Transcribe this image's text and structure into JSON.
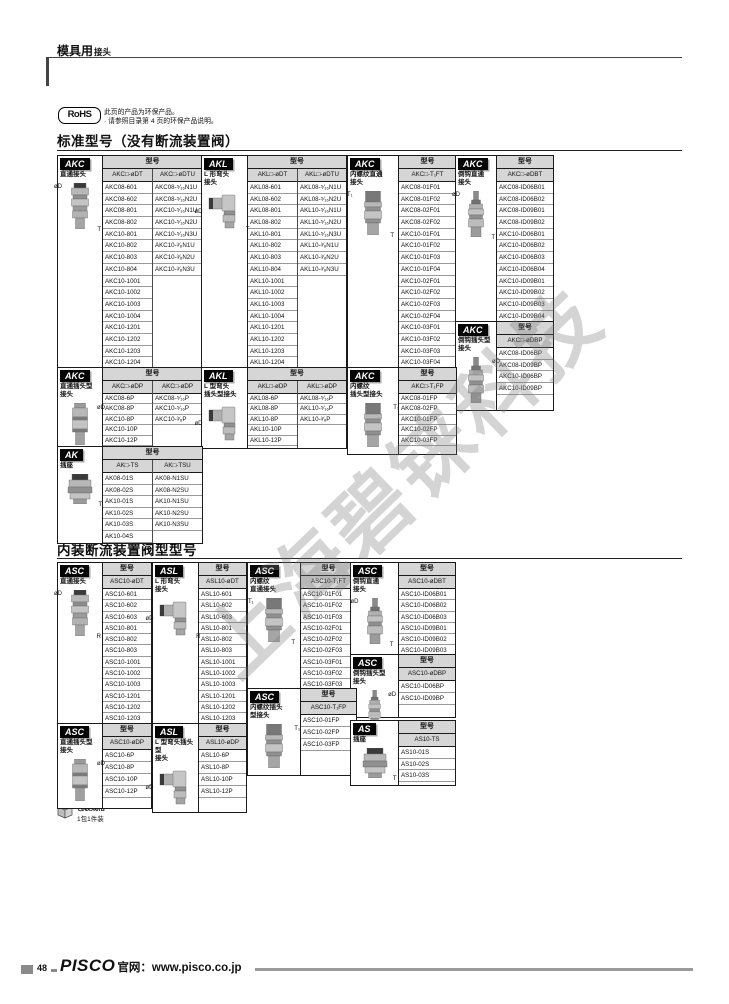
{
  "page": {
    "header_main": "模具用",
    "header_sub": "接头",
    "rohs_logo": "RoHS",
    "rohs_line1": "此页的产品为环保产品。",
    "rohs_line2": "· 请参照目录第 4 页的环保产品说明。",
    "section1_title": "标准型号（没有断流装置阀）",
    "section2_title": "内装断流装置阀型型号",
    "packaging_title": "包装规格",
    "packaging_note": "1包1件装",
    "page_number": "48",
    "footer_brand": "PISCO",
    "footer_site": "官网：www.pisco.co.jp",
    "watermark": "上海碧铼科技",
    "colors": {
      "header_bg": "#d6d6d6",
      "badge_bg": "#050505",
      "border": "#1a1a1a"
    }
  },
  "blocks": [
    {
      "id": "a1",
      "badge": "AKC",
      "label": [
        "直通接头"
      ],
      "img": "straight",
      "type_header": "型号",
      "ann": [
        {
          "t": "øD",
          "p": "tl"
        },
        {
          "t": "T",
          "p": "br"
        }
      ],
      "columns": [
        {
          "header": "AKC□-øDT",
          "rows": [
            "AKC08-601",
            "AKC08-602",
            "AKC08-801",
            "AKC08-802",
            "AKC10-801",
            "AKC10-802",
            "AKC10-803",
            "AKC10-804",
            "AKC10-1001",
            "AKC10-1002",
            "AKC10-1003",
            "AKC10-1004",
            "AKC10-1201",
            "AKC10-1202",
            "AKC10-1203",
            "AKC10-1204"
          ]
        },
        {
          "header": "AKC□-øDTU",
          "rows": [
            "AKC08-⁵⁄₁₆N1U",
            "AKC08-⁵⁄₁₆N2U",
            "AKC10-⁵⁄₁₆N1U",
            "AKC10-⁵⁄₁₆N2U",
            "AKC10-⁵⁄₁₆N3U",
            "AKC10-³⁄₈N1U",
            "AKC10-³⁄₈N2U",
            "AKC10-³⁄₈N3U"
          ]
        }
      ]
    },
    {
      "id": "a2",
      "badge": "AKL",
      "label": [
        "L 形弯头",
        "接头"
      ],
      "img": "elbow",
      "type_header": "型号",
      "ann": [
        {
          "t": "øD",
          "p": "l"
        },
        {
          "t": "T",
          "p": "br"
        }
      ],
      "columns": [
        {
          "header": "AKL□-øDT",
          "rows": [
            "AKL08-601",
            "AKL08-602",
            "AKL08-801",
            "AKL08-802",
            "AKL10-801",
            "AKL10-802",
            "AKL10-803",
            "AKL10-804",
            "AKL10-1001",
            "AKL10-1002",
            "AKL10-1003",
            "AKL10-1004",
            "AKL10-1201",
            "AKL10-1202",
            "AKL10-1203",
            "AKL10-1204"
          ]
        },
        {
          "header": "AKL□-øDTU",
          "rows": [
            "AKL08-⁵⁄₁₆N1U",
            "AKL08-⁵⁄₁₆N2U",
            "AKL10-⁵⁄₁₆N1U",
            "AKL10-⁵⁄₁₆N2U",
            "AKL10-⁵⁄₁₆N3U",
            "AKL10-³⁄₈N1U",
            "AKL10-³⁄₈N2U",
            "AKL10-³⁄₈N3U"
          ]
        }
      ]
    },
    {
      "id": "a3",
      "badge": "AKC",
      "label": [
        "内螺纹直通",
        "接头"
      ],
      "img": "fthread",
      "type_header": "型号",
      "ann": [
        {
          "t": "T₁",
          "p": "tl"
        },
        {
          "t": "T",
          "p": "br"
        }
      ],
      "columns": [
        {
          "header": "AKC□-T₁FT",
          "rows": [
            "AKC08-01F01",
            "AKC08-01F02",
            "AKC08-02F01",
            "AKC08-02F02",
            "AKC10-01F01",
            "AKC10-01F02",
            "AKC10-01F03",
            "AKC10-01F04",
            "AKC10-02F01",
            "AKC10-02F02",
            "AKC10-02F03",
            "AKC10-02F04",
            "AKC10-03F01",
            "AKC10-03F02",
            "AKC10-03F03",
            "AKC10-03F04"
          ]
        }
      ]
    },
    {
      "id": "a4",
      "badge": "AKC",
      "label": [
        "倒钩直通",
        "接头"
      ],
      "img": "barb",
      "type_header": "型号",
      "ann": [
        {
          "t": "øD",
          "p": "tl"
        },
        {
          "t": "T",
          "p": "br"
        }
      ],
      "columns": [
        {
          "header": "AKC□-øDBT",
          "rows": [
            "AKC08-ID06B01",
            "AKC08-ID06B02",
            "AKC08-ID09B01",
            "AKC08-ID09B02",
            "AKC10-ID06B01",
            "AKC10-ID06B02",
            "AKC10-ID06B03",
            "AKC10-ID06B04",
            "AKC10-ID09B01",
            "AKC10-ID09B02",
            "AKC10-ID09B03",
            "AKC10-ID09B04"
          ]
        }
      ]
    },
    {
      "id": "a5",
      "badge": "AKC",
      "label": [
        "倒钩插头型",
        "接头"
      ],
      "img": "barb",
      "type_header": "型号",
      "ann": [
        {
          "t": "øD",
          "p": "tr"
        }
      ],
      "columns": [
        {
          "header": "AKC□-øDBP",
          "rows": [
            "AKC08-ID06BP",
            "AKC08-ID09BP",
            "AKC10-ID06BP",
            "AKC10-ID09BP"
          ]
        }
      ]
    },
    {
      "id": "b1",
      "badge": "AKC",
      "label": [
        "直通插头型",
        "接头"
      ],
      "img": "plug",
      "type_header": "型号",
      "ann": [
        {
          "t": "øD",
          "p": "tr"
        }
      ],
      "columns": [
        {
          "header": "AKC□-øDP",
          "rows": [
            "AKC08-6P",
            "AKC08-8P",
            "AKC10-8P",
            "AKC10-10P",
            "AKC10-12P"
          ]
        },
        {
          "header": "AKC□-øDP",
          "rows": [
            "AKC08-⁵⁄₁₆P",
            "AKC10-⁵⁄₁₆P",
            "AKC10-³⁄₈P"
          ]
        }
      ]
    },
    {
      "id": "b2",
      "badge": "AKL",
      "label": [
        "L 型弯头",
        "插头型接头"
      ],
      "img": "elbow",
      "type_header": "型号",
      "ann": [
        {
          "t": "øD",
          "p": "l"
        }
      ],
      "columns": [
        {
          "header": "AKL□-øDP",
          "rows": [
            "AKL08-6P",
            "AKL08-8P",
            "AKL10-8P",
            "AKL10-10P",
            "AKL10-12P"
          ]
        },
        {
          "header": "AKL□-øDP",
          "rows": [
            "AKL08-⁵⁄₁₆P",
            "AKL10-⁵⁄₁₆P",
            "AKL10-³⁄₈P"
          ]
        }
      ]
    },
    {
      "id": "b3",
      "badge": "AKC",
      "label": [
        "内螺纹",
        "插头型接头"
      ],
      "img": "fthread",
      "type_header": "型号",
      "ann": [
        {
          "t": "T₁",
          "p": "tr"
        }
      ],
      "columns": [
        {
          "header": "AKC□-T₁FP",
          "rows": [
            "AKC08-01FP",
            "AKC08-02FP",
            "AKC10-01FP",
            "AKC10-02FP",
            "AKC10-03FP"
          ]
        }
      ]
    },
    {
      "id": "c1",
      "badge": "AK",
      "label": [
        "插座"
      ],
      "img": "socket",
      "type_header": "型号",
      "ann": [
        {
          "t": "T",
          "p": "br"
        }
      ],
      "columns": [
        {
          "header": "AK□-TS",
          "rows": [
            "AK08-01S",
            "AK08-02S",
            "AK10-01S",
            "AK10-02S",
            "AK10-03S",
            "AK10-04S"
          ]
        },
        {
          "header": "AK□-TSU",
          "rows": [
            "AK08-N1SU",
            "AK08-N2SU",
            "AK10-N1SU",
            "AK10-N2SU",
            "AK10-N3SU"
          ]
        }
      ]
    },
    {
      "id": "d1",
      "badge": "ASC",
      "label": [
        "直通接头"
      ],
      "img": "straight",
      "type_header": "型号",
      "ann": [
        {
          "t": "øD",
          "p": "tl"
        },
        {
          "t": "R",
          "p": "br"
        }
      ],
      "columns": [
        {
          "header": "ASC10-øDT",
          "rows": [
            "ASC10-601",
            "ASC10-602",
            "ASC10-603",
            "ASC10-801",
            "ASC10-802",
            "ASC10-803",
            "ASC10-1001",
            "ASC10-1002",
            "ASC10-1003",
            "ASC10-1201",
            "ASC10-1202",
            "ASC10-1203"
          ]
        }
      ]
    },
    {
      "id": "d2",
      "badge": "ASL",
      "label": [
        "L 形弯头",
        "接头"
      ],
      "img": "elbow",
      "type_header": "型号",
      "ann": [
        {
          "t": "øD",
          "p": "l"
        },
        {
          "t": "R",
          "p": "br"
        }
      ],
      "columns": [
        {
          "header": "ASL10-øDT",
          "rows": [
            "ASL10-601",
            "ASL10-602",
            "ASL10-603",
            "ASL10-801",
            "ASL10-802",
            "ASL10-803",
            "ASL10-1001",
            "ASL10-1002",
            "ASL10-1003",
            "ASL10-1201",
            "ASL10-1202",
            "ASL10-1203"
          ]
        }
      ]
    },
    {
      "id": "d3",
      "badge": "ASC",
      "label": [
        "内螺纹",
        "直通接头"
      ],
      "img": "fthread",
      "type_header": "型号",
      "ann": [
        {
          "t": "T₁",
          "p": "tl"
        },
        {
          "t": "T",
          "p": "br"
        }
      ],
      "columns": [
        {
          "header": "ASC10-T₁FT",
          "rows": [
            "ASC10-01F01",
            "ASC10-01F02",
            "ASC10-01F03",
            "ASC10-02F01",
            "ASC10-02F02",
            "ASC10-02F03",
            "ASC10-03F01",
            "ASC10-03F02",
            "ASC10-03F03"
          ]
        }
      ]
    },
    {
      "id": "d4",
      "badge": "ASC",
      "label": [
        "倒钩直通",
        "接头"
      ],
      "img": "barb",
      "type_header": "型号",
      "ann": [
        {
          "t": "øD",
          "p": "tl"
        },
        {
          "t": "T",
          "p": "br"
        }
      ],
      "columns": [
        {
          "header": "ASC10-øDBT",
          "rows": [
            "ASC10-ID06B01",
            "ASC10-ID06B02",
            "ASC10-ID06B03",
            "ASC10-ID09B01",
            "ASC10-ID09B02",
            "ASC10-ID09B03"
          ]
        }
      ]
    },
    {
      "id": "d5",
      "badge": "ASC",
      "label": [
        "倒钩插头型",
        "接头"
      ],
      "img": "barb",
      "type_header": "型号",
      "ann": [
        {
          "t": "øD",
          "p": "tr"
        }
      ],
      "columns": [
        {
          "header": "ASC10-øDBP",
          "rows": [
            "ASC10-ID06BP",
            "ASC10-ID09BP"
          ]
        }
      ]
    },
    {
      "id": "d6",
      "badge": "ASC",
      "label": [
        "内螺纹插头",
        "型接头"
      ],
      "img": "fthread",
      "type_header": "型号",
      "ann": [
        {
          "t": "T₁",
          "p": "tr"
        }
      ],
      "columns": [
        {
          "header": "ASC10-T₁FP",
          "rows": [
            "ASC10-01FP",
            "ASC10-02FP",
            "ASC10-03FP"
          ]
        }
      ]
    },
    {
      "id": "e1",
      "badge": "ASC",
      "label": [
        "直通插头型",
        "接头"
      ],
      "img": "plug",
      "type_header": "型号",
      "ann": [
        {
          "t": "øD",
          "p": "tr"
        }
      ],
      "columns": [
        {
          "header": "ASC10-øDP",
          "rows": [
            "ASC10-6P",
            "ASC10-8P",
            "ASC10-10P",
            "ASC10-12P"
          ]
        }
      ]
    },
    {
      "id": "e2",
      "badge": "ASL",
      "label": [
        "L 型弯头插头型",
        "接头"
      ],
      "img": "elbow",
      "type_header": "型号",
      "ann": [
        {
          "t": "øD",
          "p": "l"
        }
      ],
      "columns": [
        {
          "header": "ASL10-øDP",
          "rows": [
            "ASL10-6P",
            "ASL10-8P",
            "ASL10-10P",
            "ASL10-12P"
          ]
        }
      ]
    },
    {
      "id": "e3",
      "badge": "AS",
      "label": [
        "插座"
      ],
      "img": "socket",
      "type_header": "型号",
      "ann": [
        {
          "t": "T",
          "p": "br"
        }
      ],
      "columns": [
        {
          "header": "AS10-TS",
          "rows": [
            "AS10-01S",
            "AS10-02S",
            "AS10-03S"
          ]
        }
      ]
    }
  ]
}
